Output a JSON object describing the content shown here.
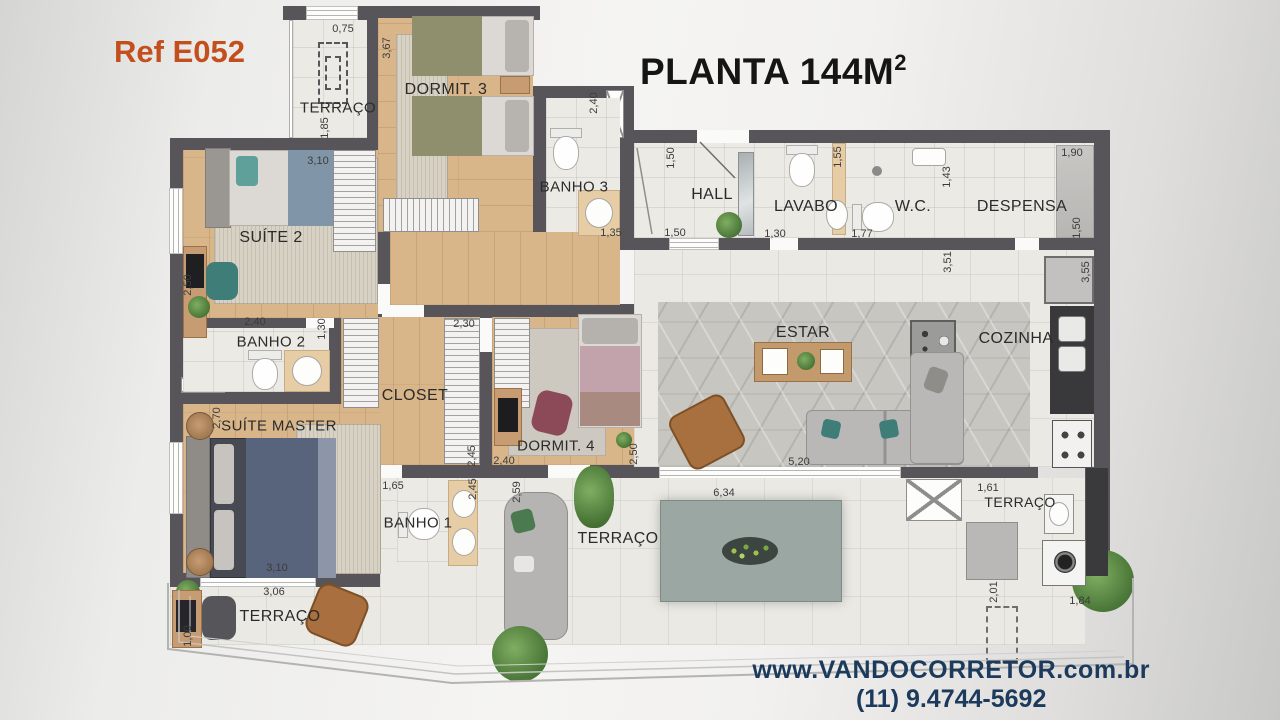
{
  "header": {
    "ref": "Ref E052",
    "title": "PLANTA 144M",
    "title_sup": "2"
  },
  "footer": {
    "website": "www.VANDOCORRETOR.com.br",
    "phone": "(11) 9.4744-5692"
  },
  "colors": {
    "ref_accent": "#c24f1c",
    "footer_text": "#1b3a5c",
    "wall": "#57555a",
    "wood_floor": "#d9b58a",
    "tile_floor": "#eceae5",
    "estar_carpet": "#c8c6c1",
    "counter_dark": "#3a3a3c",
    "counter_tan": "#e6cda6"
  },
  "rooms": {
    "terraco_top": "TERRAÇO",
    "dormit3": "DORMIT. 3",
    "banho3": "BANHO 3",
    "hall": "HALL",
    "lavabo": "LAVABO",
    "wc": "W.C.",
    "despensa": "DESPENSA",
    "suite2": "SUÍTE 2",
    "banho2": "BANHO 2",
    "closet": "CLOSET",
    "dormit4": "DORMIT. 4",
    "estar": "ESTAR",
    "cozinha": "COZINHA",
    "suite_master": "SUÍTE MASTER",
    "banho1": "BANHO 1",
    "terraco_left": "TERRAÇO",
    "terraco_main": "TERRAÇO",
    "terraco_servico": "TERRAÇO"
  },
  "dims": {
    "terraco_top_w": "0,75",
    "dormit3_h": "3,67",
    "terraco_top_h": "1,85",
    "suite2_w": "3,10",
    "banho3_h": "2,40",
    "hall_h": "1,50",
    "lavabo_h": "1,55",
    "wc_h": "1,43",
    "despensa_w": "1,90",
    "despensa_h": "1,50",
    "suite2_h": "2,50",
    "banho3_w": "1,35",
    "hall_w": "1,50",
    "lavabo_w": "1,30",
    "wc_w": "1,77",
    "cozinha_h_left": "3,51",
    "cozinha_h_right": "3,55",
    "banho2_w": "2,40",
    "banho2_h": "1,30",
    "closet_w": "2,30",
    "suite_master_h": "2,70",
    "closet_h": "2,45",
    "dormit4_w": "2,40",
    "dormit4_h": "2,50",
    "estar_w": "5,20",
    "terraco_sofa_h": "2,59",
    "banho1_w": "1,65",
    "banho1_h": "2,45",
    "suite_master_w": "3,10",
    "terraco_left_w": "3,06",
    "terraco_left_h": "1,00",
    "terraco_main_w": "6,34",
    "servico_w1": "1,61",
    "servico_h": "2,01",
    "servico_w2": "1,84"
  }
}
